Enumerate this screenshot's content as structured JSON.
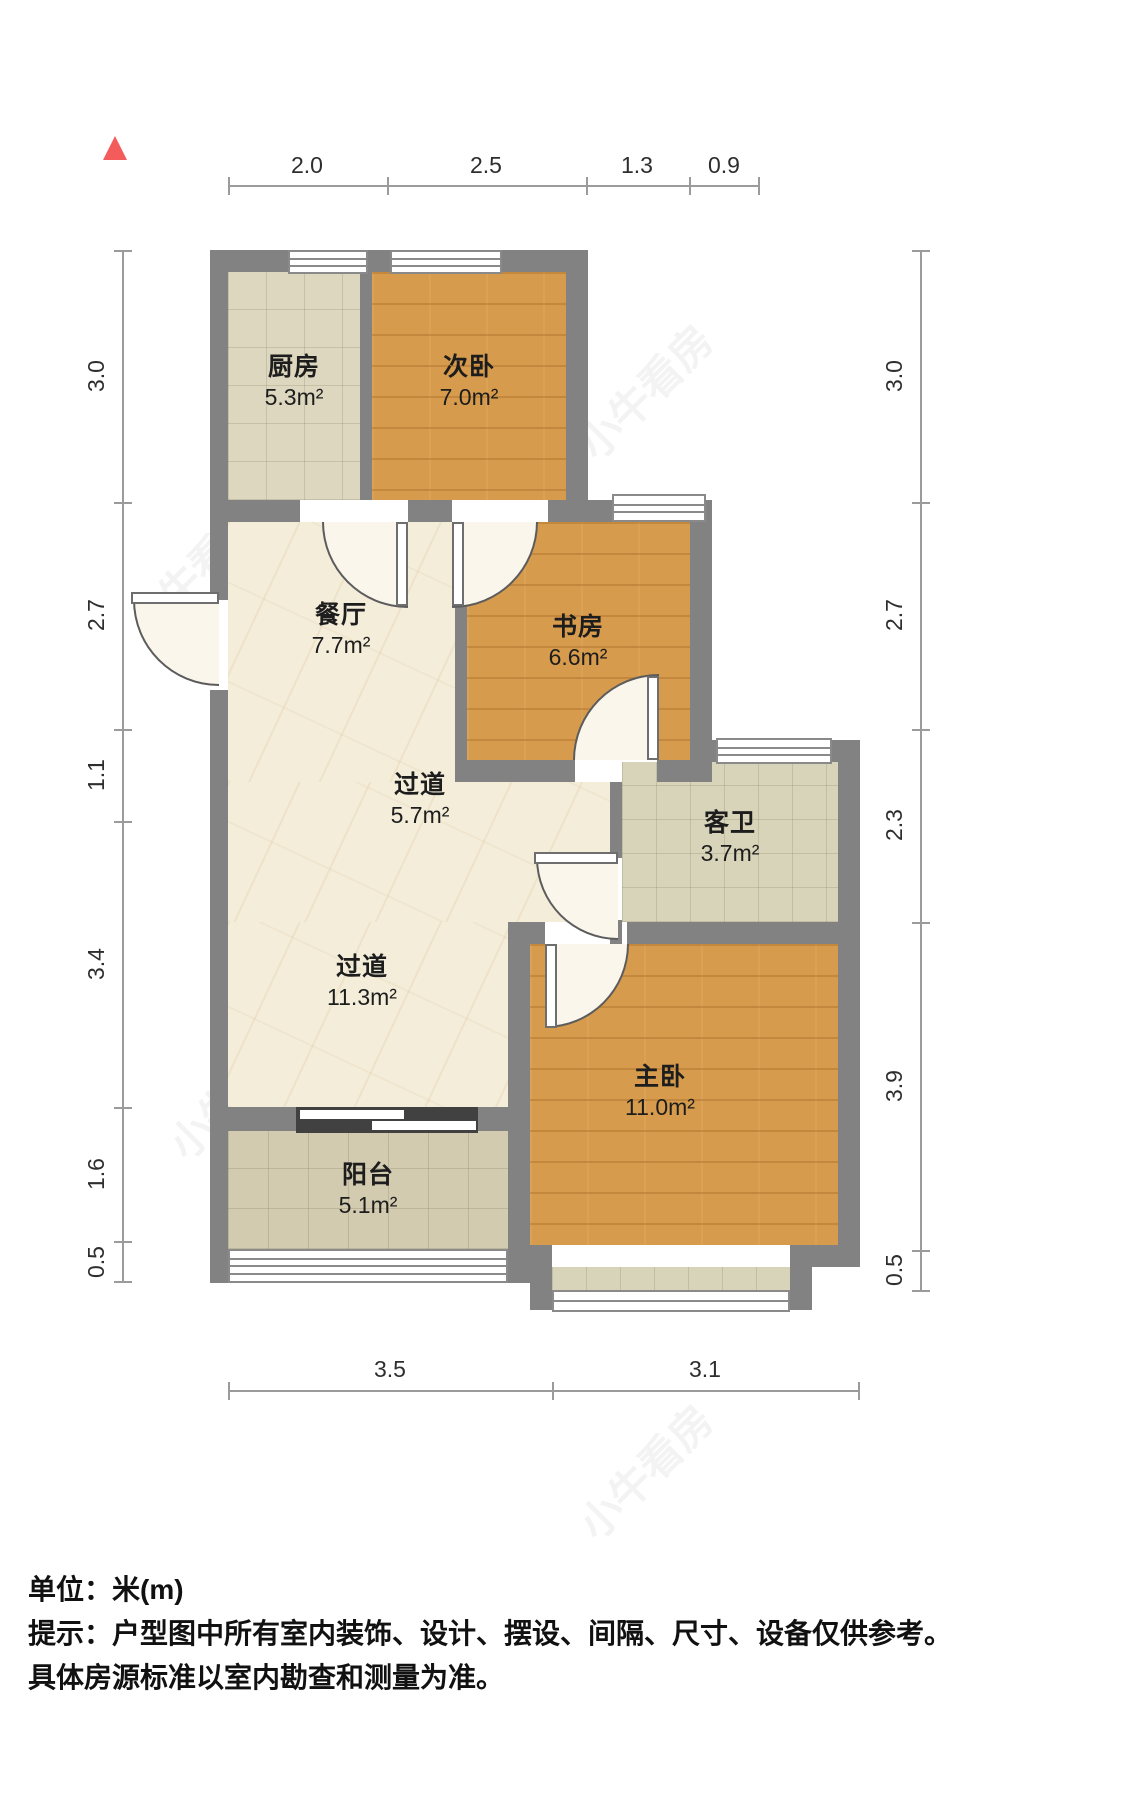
{
  "north_marker": {
    "icon": "north-arrow",
    "color": "#f45c5c"
  },
  "watermark": {
    "text": "小牛看房"
  },
  "rooms": [
    {
      "id": "kitchen",
      "name": "厨房",
      "area": "5.3m²",
      "floor": "tile"
    },
    {
      "id": "second-bedroom",
      "name": "次卧",
      "area": "7.0m²",
      "floor": "wood"
    },
    {
      "id": "dining-room",
      "name": "餐厅",
      "area": "7.7m²",
      "floor": "marble"
    },
    {
      "id": "study",
      "name": "书房",
      "area": "6.6m²",
      "floor": "wood"
    },
    {
      "id": "hallway-small",
      "name": "过道",
      "area": "5.7m²",
      "floor": "marble"
    },
    {
      "id": "guest-bathroom",
      "name": "客卫",
      "area": "3.7m²",
      "floor": "tile"
    },
    {
      "id": "hallway-large",
      "name": "过道",
      "area": "11.3m²",
      "floor": "marble"
    },
    {
      "id": "master-bedroom",
      "name": "主卧",
      "area": "11.0m²",
      "floor": "wood"
    },
    {
      "id": "balcony",
      "name": "阳台",
      "area": "5.1m²",
      "floor": "tile"
    }
  ],
  "dims": {
    "top": [
      "2.0",
      "2.5",
      "1.3",
      "0.9"
    ],
    "left": [
      "3.0",
      "2.7",
      "1.1",
      "3.4",
      "1.6",
      "0.5"
    ],
    "right": [
      "3.0",
      "2.7",
      "2.3",
      "3.9",
      "0.5"
    ],
    "bottom": [
      "3.5",
      "3.1"
    ]
  },
  "footer": {
    "unit_label": "单位：米(m)",
    "tip_line1": "提示：户型图中所有室内装饰、设计、摆设、间隔、尺寸、设备仅供参考。",
    "tip_line2": "具体房源标准以室内勘查和测量为准。"
  },
  "colors": {
    "wall": "#828282",
    "wood_floor": "#d69b4d",
    "kitchen_tile": "#ddd7bf",
    "bath_tile": "#d8d4ba",
    "balcony_tile": "#d2cbaf",
    "marble": "#f4edda",
    "dim_line": "#9b9b9b",
    "north_arrow": "#f45c5c"
  }
}
